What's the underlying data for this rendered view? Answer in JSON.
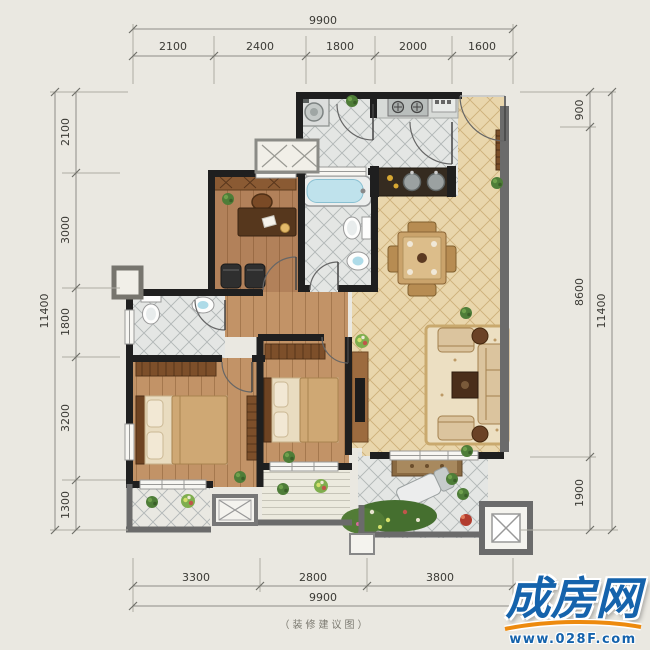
{
  "caption": "（装修建议图）",
  "watermark": {
    "brand": "成房网",
    "url": "www.028F.com"
  },
  "dimensions": {
    "top": {
      "total": "9900",
      "segments": [
        "2100",
        "2400",
        "1800",
        "2000",
        "1600"
      ]
    },
    "bottom": {
      "total": "9900",
      "segments": [
        "3300",
        "2800",
        "3800"
      ]
    },
    "left": {
      "total": "11400",
      "segments": [
        "2100",
        "3000",
        "1800",
        "3200",
        "1300"
      ]
    },
    "right": {
      "total": "11400",
      "segments": [
        "900",
        "8600",
        "1900"
      ]
    }
  },
  "colors": {
    "background": "#eae8e1",
    "wall": "#1f1f1f",
    "balcony_wall": "#6b6b6b",
    "wood_floor": "#bd8d5e",
    "tile_beige": "#e9d6ac",
    "tile_gray": "#e4e6e4",
    "dimension_line": "#8f8d86",
    "dimension_text": "#3b3a35",
    "watermark_blue": "#1563ac",
    "watermark_orange": "#ed8a0e"
  }
}
